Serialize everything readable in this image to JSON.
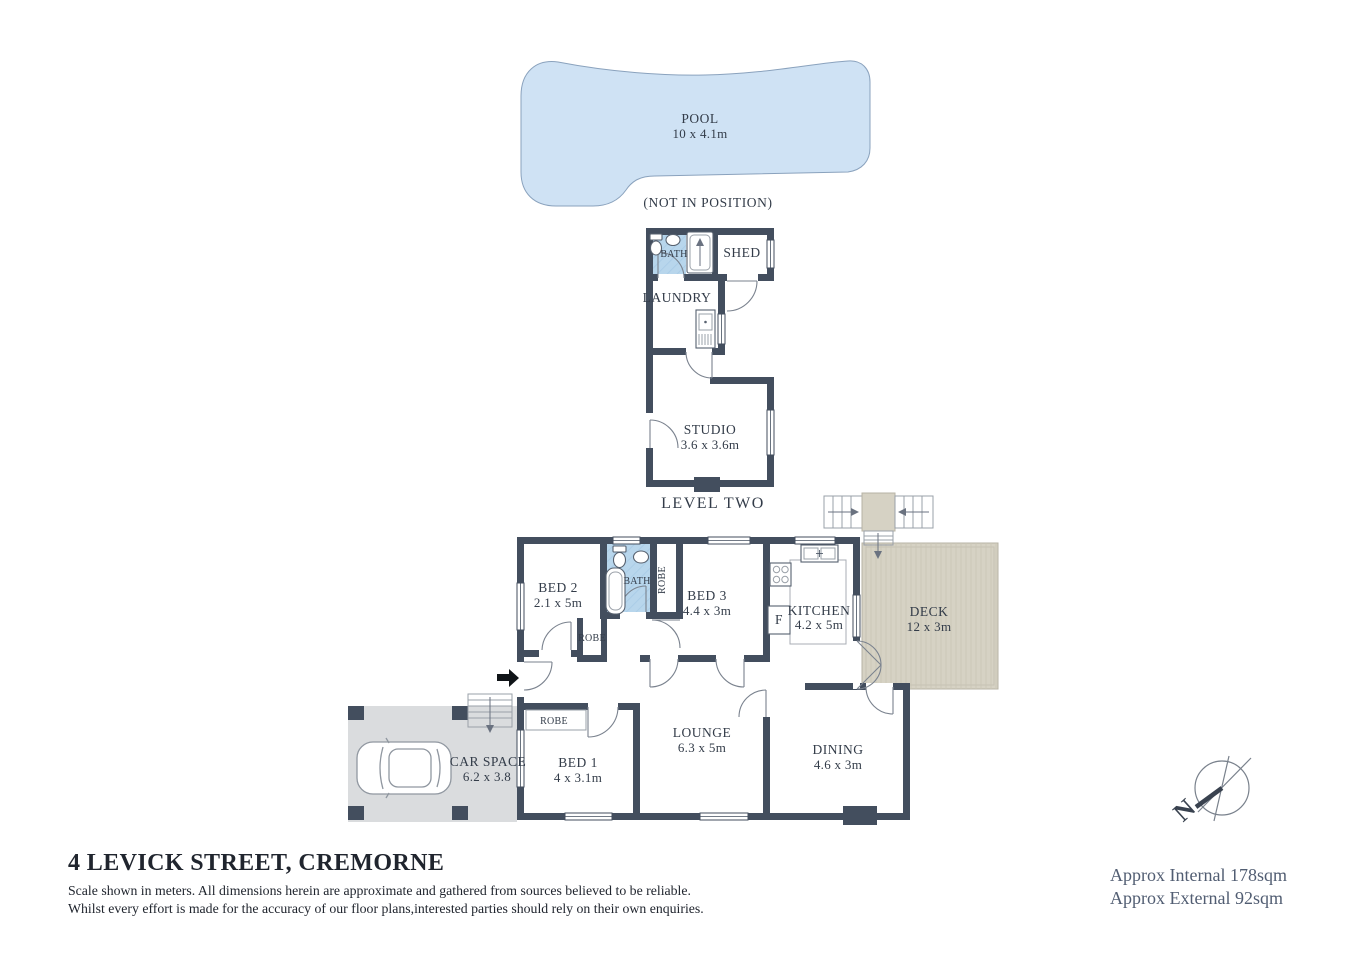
{
  "title_block": {
    "address": "4 LEVICK STREET, CREMORNE",
    "disclaimer_line1": "Scale shown in meters. All dimensions herein are approximate and gathered from sources believed to be  reliable.",
    "disclaimer_line2": "Whilst every effort is made for the accuracy of our floor plans,interested parties should rely on their own enquiries.",
    "approx_internal": "Approx Internal 178sqm",
    "approx_external": "Approx External 92sqm"
  },
  "compass": {
    "north_label": "N"
  },
  "pool": {
    "name": "POOL",
    "dims": "10 x 4.1m",
    "note": "(NOT IN POSITION)"
  },
  "level_two": {
    "section_label": "LEVEL TWO",
    "rooms": {
      "bath": {
        "name": "BATH"
      },
      "shed": {
        "name": "SHED"
      },
      "laundry": {
        "name": "LAUNDRY"
      },
      "studio": {
        "name": "STUDIO",
        "dims": "3.6 x 3.6m"
      }
    }
  },
  "level_one": {
    "rooms": {
      "bed2": {
        "name": "BED 2",
        "dims": "2.1 x 5m"
      },
      "bath": {
        "name": "BATH"
      },
      "robe_side": {
        "name": "ROBE"
      },
      "robe_bed2": {
        "name": "ROBE"
      },
      "bed3": {
        "name": "BED 3",
        "dims": "4.4 x 3m"
      },
      "kitchen": {
        "name": "KITCHEN",
        "dims": "4.2 x 5m"
      },
      "fridge": {
        "name": "F"
      },
      "deck": {
        "name": "DECK",
        "dims": "12 x 3m"
      },
      "bed1": {
        "name": "BED 1",
        "dims": "4 x 3.1m"
      },
      "robe_bed1": {
        "name": "ROBE"
      },
      "lounge": {
        "name": "LOUNGE",
        "dims": "6.3 x 5m"
      },
      "dining": {
        "name": "DINING",
        "dims": "4.6 x 3m"
      },
      "car_space": {
        "name": "CAR SPACE",
        "dims": "6.2 x 3.8"
      }
    }
  },
  "colors": {
    "wall": "#434e5e",
    "pool": "#cfe2f4",
    "bath_floor": "#b8d6ec",
    "deck": "#d6d2c4",
    "car_pad": "#dadcde",
    "text": "#333c49",
    "muted_text": "#515d72"
  }
}
